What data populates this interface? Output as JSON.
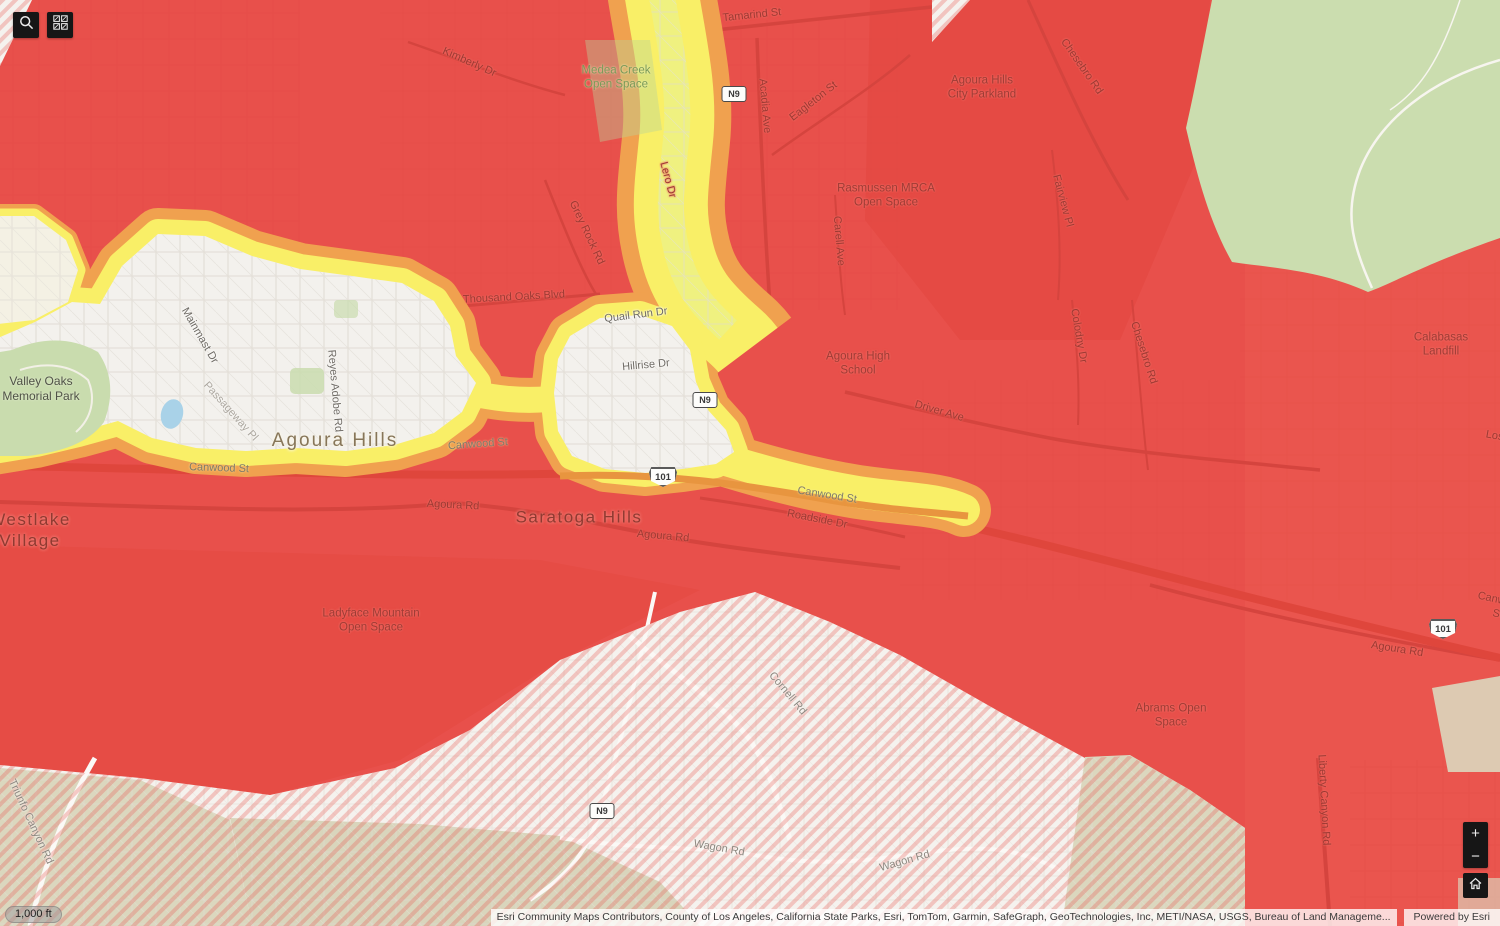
{
  "map": {
    "labels": [
      {
        "text": "Tamarind St"
      },
      {
        "text": "Kimberly Dr"
      },
      {
        "text": "Medea Creek\nOpen Space"
      },
      {
        "text": "Acadia Ave"
      },
      {
        "text": "Eagleton St"
      },
      {
        "text": "Agoura Hills\nCity Parkland"
      },
      {
        "text": "Chesebro Rd"
      },
      {
        "text": "Rasmussen MRCA\nOpen Space"
      },
      {
        "text": "Fairview Pl"
      },
      {
        "text": "Carell Ave"
      },
      {
        "text": "Grey Rock Rd"
      },
      {
        "text": "Lero Dr"
      },
      {
        "text": "Calabasas\nLandfill"
      },
      {
        "text": "Colodny Dr"
      },
      {
        "text": "Chesebro Rd"
      },
      {
        "text": "Thousand Oaks Blvd"
      },
      {
        "text": "Quail Run Dr"
      },
      {
        "text": "Hillrise Dr"
      },
      {
        "text": "Mainmast Dr"
      },
      {
        "text": "Passageway Pl"
      },
      {
        "text": "Reyes Adobe Rd"
      },
      {
        "text": "Valley Oaks\nMemorial Park"
      },
      {
        "text": "Agoura Hills"
      },
      {
        "text": "Canwood St"
      },
      {
        "text": "Canwood St"
      },
      {
        "text": "Agoura High\nSchool"
      },
      {
        "text": "Driver Ave"
      },
      {
        "text": "Canwood St"
      },
      {
        "text": "Roadside Dr"
      },
      {
        "text": "Agoura Rd"
      },
      {
        "text": "Agoura Rd"
      },
      {
        "text": "Saratoga Hills"
      },
      {
        "text": "Westlake\nVillage"
      },
      {
        "text": "Ladyface Mountain\nOpen Space"
      },
      {
        "text": "Cornell Rd"
      },
      {
        "text": "Wagon Rd"
      },
      {
        "text": "Wagon Rd"
      },
      {
        "text": "Abrams Open\nSpace"
      },
      {
        "text": "Liberty Canyon Rd"
      },
      {
        "text": "Agoura Rd"
      },
      {
        "text": "Triunfo Canyon Rd"
      },
      {
        "text": "Canwood St"
      },
      {
        "text": "Lost"
      }
    ],
    "shields": {
      "n9": "N9",
      "us101": "101"
    },
    "colors": {
      "hazard_red": "#E8504B",
      "hazard_orange": "#F0A14F",
      "hazard_yellow": "#F9EF67",
      "basemap_light": "#F3F1ED",
      "open_space_green": "#CBDDAF"
    }
  },
  "controls": {
    "zoom_in": "+",
    "zoom_out": "−"
  },
  "scalebar": {
    "text": "1,000 ft"
  },
  "attribution": {
    "text": "Esri Community Maps Contributors, County of Los Angeles, California State Parks, Esri, TomTom, Garmin, SafeGraph, GeoTechnologies, Inc, METI/NASA, USGS, Bureau of Land Manageme...",
    "powered_by": "Powered by Esri"
  }
}
